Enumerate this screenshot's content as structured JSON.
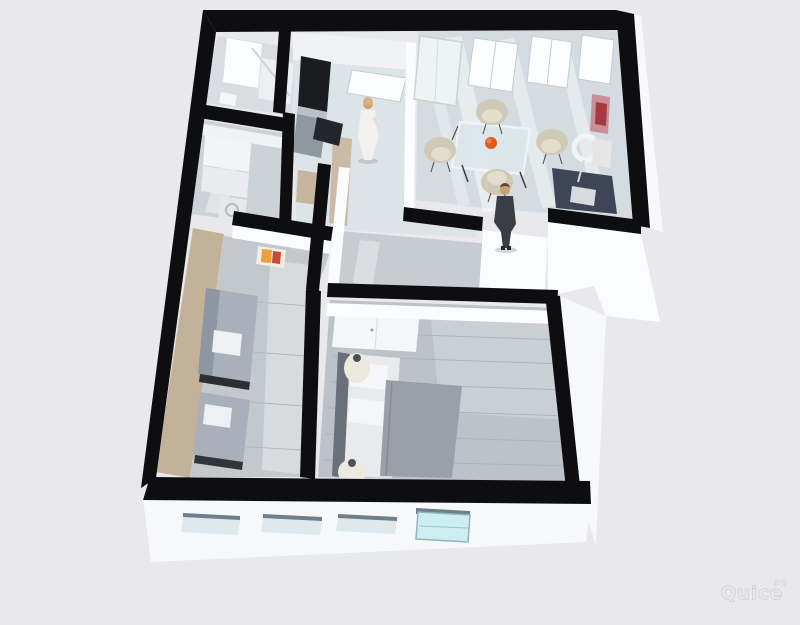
{
  "scene": {
    "kind": "3d-floorplan-render",
    "watermark": {
      "text": "Quice",
      "superscript": "3D"
    }
  },
  "colors": {
    "background": "#e9e9ec",
    "wall_black": "#0e0e11",
    "wall_white": "#fbfcfd",
    "wall_white_shade": "#f1f2f5",
    "facade_white": "#f7f8fa",
    "accent_tan": "#c3b29a",
    "floor_cool": "#d4dce1",
    "floor_kitchen": "#dde4e8",
    "floor_hall": "#cdd2d6",
    "floor_corridor": "#c7ccd1",
    "floor_wood_living": "#c3c8cd",
    "floor_wood_bedroom": "#bcc2c7",
    "counter_gray": "#8f979f",
    "appliance_dark": "#1a1c20",
    "sofa_navy": "#3e4557",
    "sofa_gray": "#a9b0ba",
    "pillow_white": "#eef0f4",
    "chair_beige": "#cfc9b6",
    "chair_seat": "#e3ddcb",
    "bed_duvet": "#9aa0a8",
    "bed_sheet": "#e8eaee",
    "lamp_cream": "#eceadf",
    "accent_orange": "#de5a1e",
    "artwork_pink": "#c98f96",
    "artwork_red": "#a43a3f",
    "glass_cyan": "#cdeef1",
    "window_bright": "#fbfdfe",
    "window_recess": "#dfe8ed",
    "recess_lip": "#6c7f8a",
    "suit_dark": "#3a3d44",
    "dress_white": "#f2f1ef",
    "skin": "#c9a07a",
    "hair_blonde": "#d8b084",
    "hair_brown": "#5d4634",
    "watermark_stroke": "#c6c6cb",
    "watermark_fill": "#e7e7ea"
  },
  "objects": [
    "bathroom-shower",
    "hallway-closet",
    "washing-machine",
    "kitchen-counter",
    "kitchen-tall-cabinet",
    "kitchen-window",
    "dining-table-glass",
    "dining-chairs-x4",
    "fruit-bowl-orange",
    "navy-sofa",
    "ring-floor-lamp",
    "wall-artwork",
    "living-sofa-x2",
    "living-artwork",
    "bedroom-wardrobe",
    "double-bed",
    "bedside-lamps-x2",
    "woman-figure",
    "man-figure",
    "front-facade-windows",
    "glass-entry-door"
  ]
}
